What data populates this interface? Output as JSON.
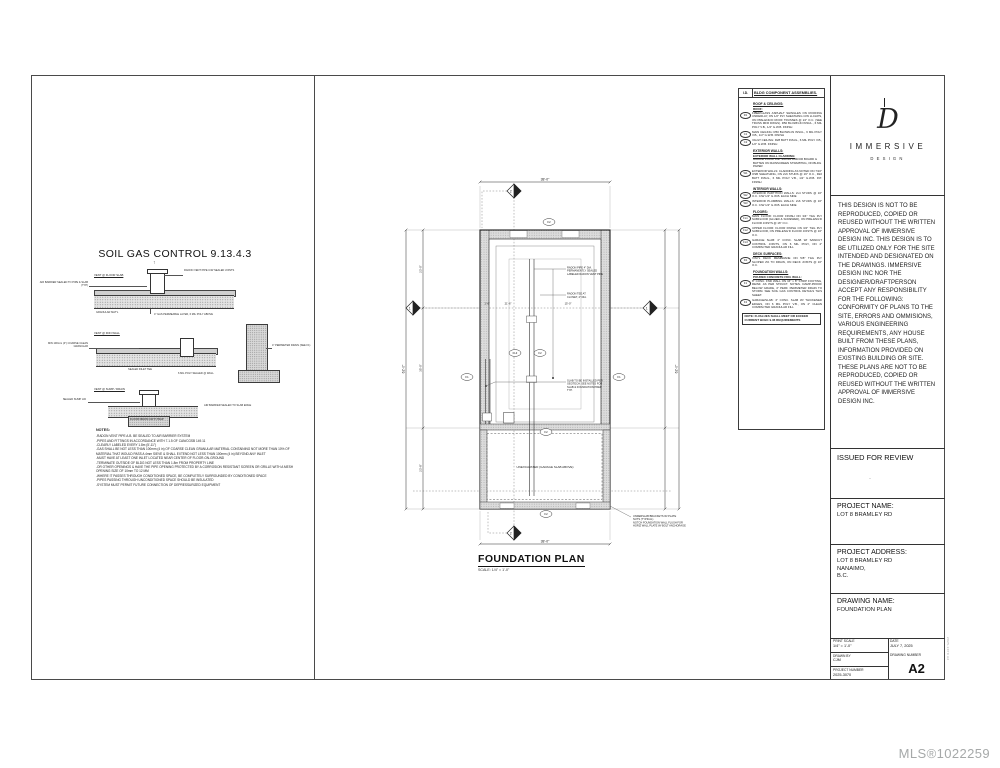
{
  "watermark": "MLS®1022259",
  "left_panel": {
    "title": "SOIL GAS CONTROL 9.13.4.3",
    "details": {
      "d1": {
        "caption": "VENT @ FLOOR SLAB",
        "left_note": "AIR BARRIER SEALED TO PIPE & SLAB (TYP)",
        "right_note": "RADON VENT PIPE C/W SEALED JOINTS",
        "note_a": "GRANULAR MAT'L",
        "note_b": "4\" GAS PERMEABLE LAYER, 6 MIL POLY ABOVE"
      },
      "d2": {
        "caption": "VENT @ FDN WALL",
        "left_note": "MIN 100mm (4\") COARSE CLEAN GRANULAR",
        "right_note": "4\" PERIMETER DRAIN (SEE F1)",
        "note_a": "SEALED INLET TEE",
        "note_b": "6 MIL POLY SEALED @ WALL"
      },
      "d3": {
        "caption": "VENT @ SUMP / DRAIN",
        "left_note": "SEALED SUMP LID",
        "right_note": "AIR BARRIER SEALED TO SLAB EDGE",
        "note_a": "FLOOR DRAIN C/W P-TRAP"
      }
    },
    "notes_label": "NOTES:",
    "notes": [
      "-RADON VENT PIPE A.B. BE SEALED TO AIR BARRIER SYSTEM",
      "-PIPES AND FITTINGS IN ACCORDANCE WITH 7.1.5 OF CAN/CGSB 149.11",
      "-CLEARLY LABELED EVERY 1.8m (5'-11\")",
      "-GAS SHALL BE NOT LESS THAN 100mm (4 in) OF COARSE CLEAN GRANULAR MATERIAL CONTAINING NOT MORE THAN 10% OF MATERIAL THAT WOULD PASS A 4mm SIEVE & SHALL EXTEND NOT LESS THAN 100mm (4 in) BEYOND ANY INLET",
      "-MUST HAVE AT LEAST ONE INLET LOCATED NEAR CENTER OF FLOOR-ON-GROUND",
      "-TERMINATE OUTSIDE OF BLDG NOT LESS THAN 1.8m FROM PROPERTY LINE",
      "-OR OTHER OPENINGS & HAVE THE PIPE OPENING PROTECTED BY A CORROSION RESISTANT SCREEN OR GRILLE WITH A MESH OPENING SIZE OF 10mm TO 12 MM",
      "-WHERE IT PASSES THROUGH CONDITIONED SPACE, BE COMPLETELY SURROUNDED BY CONDITIONED SPACE",
      "-PIPES PASSING THROUGH UNCONDITIONED SPACE SHOULD BE INSULATED",
      "-SYSTEM MUST PERMIT FUTURE CONNECTION OF DEPRESSURIZED EQUIPMENT"
    ]
  },
  "legend": {
    "id_header": "I.D.",
    "title": "BLDG COMPONENT ASSEMBLIES.",
    "sections": [
      {
        "heading": "ROOF & CEILINGS:",
        "sub": "ROOF:",
        "items": [
          {
            "id": "R1",
            "text": "FIBERGLASS ASPHALT SHINGLES ON ROOFING UNDERLAY, ON 1/2\" PLY SHEATHING C/W H-CLIPS, ON PRE-ENG'D ROOF TRUSSES @ 24\" O.C. (SEE TRUSS MFR DWGS). R50 BLOWN-IN INSUL., 6 MIL POLY V.B., 1/2\" G.W.B. FINISH"
          },
          {
            "id": "C1",
            "text": "MAIN CEILING: R50 BLOWN-IN INSUL., 6 MIL POLY V.B., 1/2\" G.W.B. FINISH"
          },
          {
            "id": "C2",
            "text": "VAULT CEILING: R28 BATT INSUL., 6 MIL POLY V.B., 1/2\" G.W.B. FINISH"
          }
        ]
      },
      {
        "heading": "EXTERIOR WALLS:",
        "sub": "EXTERIOR WALL CLADDING:",
        "intro": "HARDIE PLANK LAP SIDING AND/OR BOARD & BATTEN ON RAINSCREEN STRAPPING, ON BLDG PAPER",
        "items": [
          {
            "id": "W1",
            "text": "EXTERIOR WALLS: CLADDING AS NOTED ON 7/16\" OSB SHEATHING, ON 2x6 STUDS @ 16\" O.C., R22 BATT INSUL., 6 MIL POLY V.B., 1/2\" G.W.B. INT. FINISH"
          }
        ]
      },
      {
        "heading": "INTERIOR WALLS:",
        "items": [
          {
            "id": "W2",
            "text": "INTERIOR PARTITION WALLS: 2x4 STUDS @ 16\" O.C. C/W 1/2\" G.W.B. EACH SIDE"
          },
          {
            "id": "W3",
            "text": "INTERIOR PLUMBING WALLS: 2x6 STUDS @ 16\" O.C. C/W 1/2\" G.W.B. EACH SIDE"
          }
        ]
      },
      {
        "heading": "FLOORS:",
        "items": [
          {
            "id": "FL1",
            "text": "MAIN FLOOR: FLOOR FINISH ON 3/4\" T&G PLY SUBFLOOR (GLUED & SCREWED), ON PRE-ENG'D FLOOR JOISTS @ 16\" O.C."
          },
          {
            "id": "FL2",
            "text": "UPPER FLOOR: FLOOR FINISH ON 3/4\" T&G PLY SUBFLOOR, ON PRE-ENG'D FLOOR JOISTS @ 16\" O.C."
          },
          {
            "id": "FL3",
            "text": "GARAGE SLAB: 4\" CONC. SLAB W/ SAWCUT CONTROL JOINTS, ON 6 MIL POLY, ON 4\" COMPACTED GRANULAR FILL"
          }
        ]
      },
      {
        "heading": "DECK SURFACES:",
        "items": [
          {
            "id": "D1",
            "text": "VINYL DECK MEMBRANE ON 5/8\" T&G PLY SLOPED 2% TO DRAIN, ON DECK JOISTS @ 16\" O.C."
          }
        ]
      },
      {
        "heading": "FOUNDATION WALLS:",
        "sub": "POURED CONCRETE FDN. WALL:",
        "items": [
          {
            "id": "F1",
            "text": "8\" CONC. FND WALL ON 16\" x 8\" STRIP FOOTING, REINF. AS PER STRUCT. NOTES. DAMP-PROOF BELOW GRADE, 4\" PERF. PERIMETER DRAIN TO STORM. SEE SOIL GAS CONTROL DETAILS THIS SHEET."
          },
          {
            "id": "F2",
            "text": "GARAGE/SLAB: 4\" CONC. SLAB W/ THICKENED EDGES, ON 6 MIL POLY V.B., ON 4\" CLEAN COMPACTED GRANULAR FILL"
          }
        ]
      }
    ],
    "note": "NOTE: R-VALUES SHALL MEET OR EXCEED CURRENT BCBC 9.36 REQUIREMENTS"
  },
  "plan": {
    "title": "FOUNDATION PLAN",
    "scale": "SCALE: 1/4\" = 1'-0\"",
    "unexcavated": "UNEXCAVATED (GARAGE SLAB ABOVE)",
    "dims": {
      "top": "38'-0\"",
      "bottom": "38'-0\"",
      "left": "62'-0\"",
      "right": "62'-0\"",
      "l1": "23'-0\"",
      "l2": "35'-0\"",
      "l3": "23'-8\"",
      "s1": "1'-6\"",
      "s2": "21'-6\"",
      "s3": "15'-0\""
    },
    "badges": {
      "top": "F2",
      "left": "F1",
      "right": "F1",
      "m1": "FL3",
      "m2": "F2",
      "low": "F2",
      "bottom": "F2"
    },
    "markers": {
      "top": "2",
      "bottom": "2",
      "left": "1",
      "right": "1"
    },
    "callouts": {
      "c1": [
        "RADON PIPE 4\" DIA.",
        "PERMANENTLY SEALED",
        "LABELED RADON VENT PIPE"
      ],
      "c2": [
        "RADON TEE AT",
        "CLOSET, 4\" DIA."
      ],
      "c3": [
        "SLAB TO BE INSTALLED PER",
        "GEOTECH. SEE NOTES FOR",
        "SLAB & FOUNDATION PREP.",
        "TYP."
      ],
      "c4": [
        "UNDERSLAB BRACKETS W/ PLATE",
        "NUTS (TYPICAL)",
        "NOTCH FOUNDATION WALL FLUSH FOR",
        "HORIZ WALL PLATE W/ BOLT ANCHORAGE"
      ]
    }
  },
  "title_block": {
    "logo_word": "IMMERSIVE",
    "logo_sub": "DESIGN",
    "logo_glyph": "D",
    "disclaimer": "THIS DESIGN IS NOT TO BE REPRODUCED, COPIED OR REUSED WITHOUT THE WRITTEN APPROVAL OF IMMERSIVE DESIGN INC. THIS DESIGN IS TO BE UTILIZED ONLY FOR THE SITE INTENDED AND DESIGNATED ON THE DRAWINGS. IMMERSIVE DESIGN INC NOR THE DESIGNER/DRAFTPERSON ACCEPT ANY RESPONSIBILITY FOR THE FOLLOWING: CONFORMITY OF PLANS TO THE SITE, ERRORS AND OMMISIONS, VARIOUS ENGINEERING REQUIREMENTS, ANY HOUSE BUILT FROM THESE PLANS, INFORMATION PROVIDED ON EXISTING BUILDING OR SITE. THESE PLANS ARE NOT TO BE REPRODUCED, COPIED OR REUSED WITHOUT THE WRITTEN APPROVAL OF IMMERSIVE DESIGN INC.",
    "issued": "ISSUED FOR REVIEW",
    "issued_mark": "·",
    "project_name_label": "PROJECT NAME:",
    "project_name": "LOT 8 BRAMLEY RD",
    "project_address_label": "PROJECT ADDRESS:",
    "address_1": "LOT 8 BRAMLEY RD",
    "address_2": "NANAIMO,",
    "address_3": "B.C.",
    "drawing_name_label": "DRAWING NAME:",
    "drawing_name": "FOUNDATION PLAN",
    "print_scale_label": "PRINT SCALE",
    "print_scale": "1/4\" = 1'-0\"",
    "date_label": "DATE",
    "date": "JULY 7, 2025",
    "drawn_by_label": "DRAWN BY",
    "drawn_by": "CJM",
    "project_number_label": "PROJECT NUMBER",
    "project_number": "2025-3070",
    "drawing_number_label": "DRAWING NUMBER",
    "drawing_number": "A2",
    "side_text": "2025-3070 A2"
  }
}
